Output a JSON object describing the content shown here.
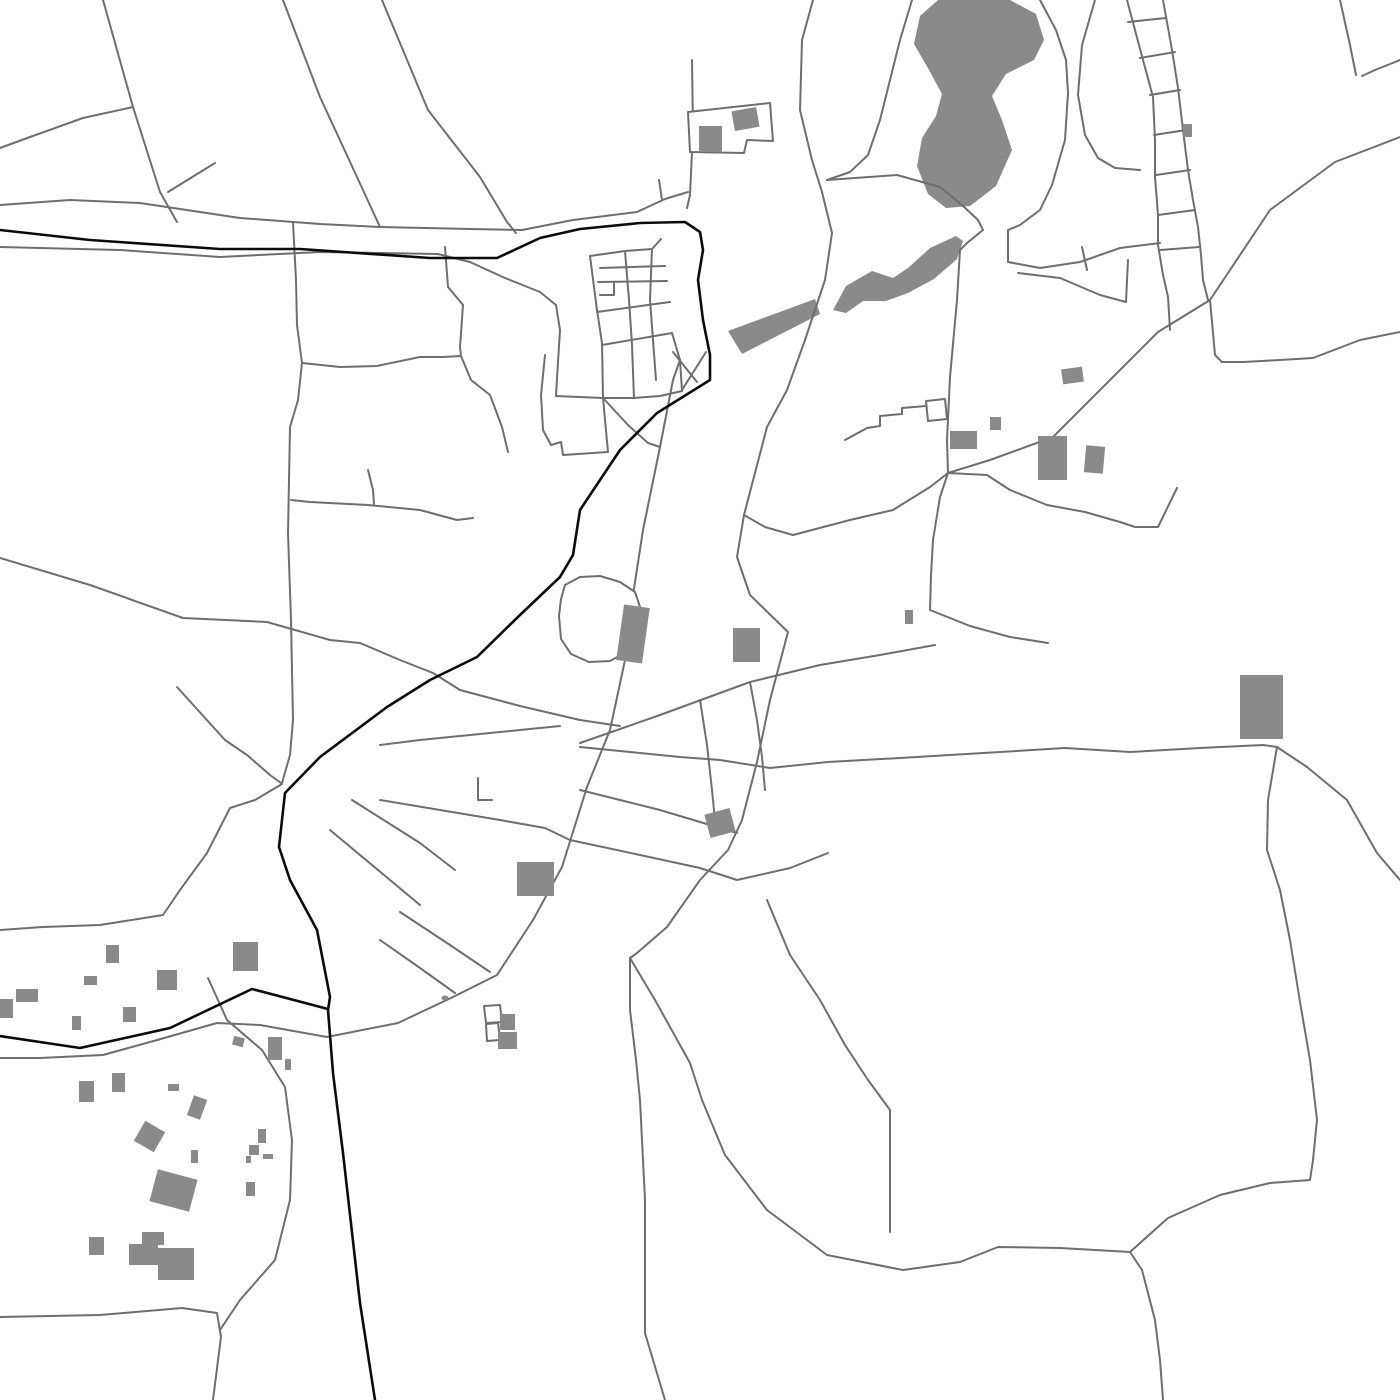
{
  "map": {
    "canvas": {
      "width": 1400,
      "height": 1400
    },
    "palette": {
      "background": "#ffffff",
      "road_gray": "#6e6e6e",
      "major_route_black": "#0b0b0b",
      "feature_fill_gray": "#8a8a8a",
      "outline_fill": "#ffffff"
    },
    "stroke": {
      "road_width": 2,
      "major_width": 2.6,
      "outline_width": 2
    },
    "major_routes": [
      {
        "points": "0,230 90,240 220,249 300,249 430,258 497,258 540,238 580,229 640,223 685,222 700,232 703,250 698,280 703,320 710,355 710,380 657,413 620,450 580,510 573,555 560,577 520,615 477,657 430,680 387,707 320,757 285,793 279,847 290,880 317,930 330,997 328,1010 333,1073 343,1153 360,1303 375,1400"
      },
      {
        "points": "0,1036 80,1048 170,1028 252,989 328,1009"
      }
    ],
    "roads": [
      {
        "points": "103,0 133,107 160,192 177,222"
      },
      {
        "points": "133,107 83,118 30,137 0,148"
      },
      {
        "points": "168,192 215,163"
      },
      {
        "points": "283,0 320,97 357,177 380,227"
      },
      {
        "points": "382,0 428,110 480,177 507,222 516,233"
      },
      {
        "points": "0,205 70,200 140,203 240,218 320,224 380,227 470,229 522,230 573,220 637,212 665,199 688,192"
      },
      {
        "points": "662,200 659,180"
      },
      {
        "points": "0,247 120,250 220,257 320,252 438,254"
      },
      {
        "points": "438,254 470,262 505,278 540,292 556,305 560,330 558,362 556,395"
      },
      {
        "points": "692,60 693,130 690,195 687,208"
      },
      {
        "points": "813,0 802,40 800,110 812,160 822,192 832,233"
      },
      {
        "points": "590,256 625,251 652,249 661,239"
      },
      {
        "points": "590,256 597,310 602,343 603,398"
      },
      {
        "points": "625,251 629,300 632,345 634,398"
      },
      {
        "points": "652,249 650,300 653,340 656,380"
      },
      {
        "points": "600,268 665,266"
      },
      {
        "points": "598,282 667,281"
      },
      {
        "points": "597,312 670,302"
      },
      {
        "points": "602,345 672,333"
      },
      {
        "points": "600,295 614,295 614,283"
      },
      {
        "points": "556,396 603,398 634,398 660,396 682,391"
      },
      {
        "points": "682,391 680,360 672,333"
      },
      {
        "points": "603,398 628,425 648,443 660,447"
      },
      {
        "points": "673,352 697,382"
      },
      {
        "points": "706,352 682,390"
      },
      {
        "points": "545,355 541,395 543,430 551,445 561,442 563,455 608,452 603,398"
      },
      {
        "points": "832,233 825,280 805,340 787,390 767,427 744,515 737,557 750,595 788,632 770,700 757,762 742,820 728,850 700,880 667,927 637,953 630,958"
      },
      {
        "points": "680,360 673,380 660,447 643,530 633,595 633,623 610,730 587,787 562,867 533,920 497,975 453,997 398,1023 327,1037 260,1025 217,1023 150,1042 103,1055 40,1058 0,1058"
      },
      {
        "points": "293,222 296,280 297,325 302,363 298,400 290,427 288,533 291,620 293,720 290,755 282,783"
      },
      {
        "points": "445,247 448,287 463,305 460,347 461,356"
      },
      {
        "points": "302,363 340,367 377,366 420,357 443,357 461,356 471,380 490,395 502,427 508,452"
      },
      {
        "points": "291,500 310,502 368,505 420,510 457,520 473,518"
      },
      {
        "points": "368,470 373,490 374,504"
      },
      {
        "points": "0,558 90,585 183,618 267,622 330,640 360,643 400,660 433,673 460,690 520,706 580,720 620,726"
      },
      {
        "points": "177,687 225,740 247,755 270,775 281,783"
      },
      {
        "points": "282,784 255,800 230,808 207,853 180,890 163,915 100,925 43,927 0,930"
      },
      {
        "points": "208,978 218,1000 227,1020 262,1050 285,1087 292,1140 290,1200 275,1260 240,1300 220,1330"
      },
      {
        "points": "0,1317 100,1315 182,1308 217,1313 221,1337 213,1400"
      },
      {
        "points": "630,958 630,1010 636,1060 640,1100 645,1200 645,1333 665,1400"
      },
      {
        "points": "630,958 655,1000 690,1063 702,1100 725,1155 767,1210 827,1255 903,1270 960,1262 998,1247 1060,1248 1130,1252"
      },
      {
        "points": "1130,1252 1168,1218 1220,1195 1270,1183 1310,1180"
      },
      {
        "points": "1130,1252 1142,1270 1155,1320 1160,1360 1163,1400"
      },
      {
        "points": "767,900 790,955 820,1000 845,1045 868,1080 890,1110 890,1232"
      },
      {
        "points": "1400,137 1335,162 1270,210 1210,300 1158,332 1110,380 1053,437 990,460 948,473"
      },
      {
        "points": "948,473 947,440 950,377 957,300 960,250 967,243 983,230"
      },
      {
        "points": "827,180 897,175 940,187 962,205 978,220 983,230"
      },
      {
        "points": "948,473 940,497 933,540 931,575 930,610 970,626 1010,637 1048,643"
      },
      {
        "points": "948,473 930,487 893,510 850,520 793,535 765,527 744,515"
      },
      {
        "points": "948,473 987,475 1010,490 1047,505 1085,512 1120,522 1135,527 1158,527 1177,488"
      },
      {
        "points": "770,768 828,762 900,758 1000,752 1065,748 1130,752 1200,748 1263,745 1277,747"
      },
      {
        "points": "1277,747 1268,800 1267,850 1280,890 1290,940 1300,1002 1310,1060 1317,1120 1313,1160 1310,1180"
      },
      {
        "points": "1277,747 1307,767 1347,800 1377,853 1400,880"
      },
      {
        "points": "1210,300 1215,355 1222,362 1243,362 1280,360 1313,358 1360,340 1400,332"
      },
      {
        "points": "1127,0 1143,60 1153,97 1155,140 1155,177 1158,215 1158,245 1163,275 1168,297 1170,330"
      },
      {
        "points": "1163,0 1172,50 1178,88 1183,130 1188,170 1193,200 1198,227 1201,255 1203,280 1208,300"
      },
      {
        "points": "1128,22 1166,18"
      },
      {
        "points": "1140,58 1175,52"
      },
      {
        "points": "1150,95 1180,90"
      },
      {
        "points": "1154,135 1186,130"
      },
      {
        "points": "1156,175 1190,170"
      },
      {
        "points": "1158,215 1195,210"
      },
      {
        "points": "1160,250 1199,247"
      },
      {
        "points": "1095,0 1082,45 1078,95 1085,135 1098,158 1115,168 1140,170"
      },
      {
        "points": "1340,0 1350,45 1356,75"
      },
      {
        "points": "1400,60 1375,70 1362,76"
      },
      {
        "points": "1008,230 1008,262 1040,268 1080,262 1120,248 1160,243"
      },
      {
        "points": "1082,247 1087,270"
      },
      {
        "points": "1018,273 1060,278 1100,295 1126,302"
      },
      {
        "points": "1126,302 1128,260"
      },
      {
        "points": "912,0 900,40 890,80 880,120 868,155 850,172 827,180"
      },
      {
        "points": "1040,0 1056,30 1066,60 1068,93 1065,140 1052,185 1040,210 1020,225 1008,230"
      },
      {
        "points": "580,743 660,715 750,682 820,665 880,655 935,645"
      },
      {
        "points": "580,747 630,752 680,757 720,760 770,768"
      },
      {
        "points": "580,790 620,800 660,810 700,822 737,833"
      },
      {
        "points": "570,840 640,855 700,868 737,880 790,868 828,853"
      },
      {
        "points": "700,700 707,745 712,790 716,830"
      },
      {
        "points": "750,682 757,720 762,757 765,790"
      },
      {
        "points": "380,745 420,740 470,735 520,730 560,726"
      },
      {
        "points": "478,778 478,800 492,800"
      },
      {
        "points": "380,800 440,810 500,820 545,828 570,840"
      },
      {
        "points": "400,912 450,945 490,972"
      },
      {
        "points": "380,940 420,968 455,993"
      },
      {
        "points": "352,800 420,843 455,870"
      },
      {
        "points": "330,830 390,880 420,905"
      },
      {
        "points": "845,440 867,428 880,426 880,416 902,414 902,408 926,406"
      }
    ],
    "water_bodies": [
      {
        "points": "938,0 1010,0 1036,14 1044,40 1034,60 1006,74 992,96 1002,120 1012,150 996,186 970,206 946,208 928,194 917,166 922,138 936,116 942,94 929,70 914,44 920,16"
      },
      {
        "points": "833,310 846,286 872,271 893,278 908,268 930,248 956,236 963,241 957,259 934,279 908,293 886,301 863,301 846,313"
      },
      {
        "points": "728,331 815,299 820,314 742,354"
      }
    ],
    "outlined_features": [
      {
        "points": "688,112 770,103 773,141 747,140 744,153 690,152"
      },
      {
        "points": "926,401 945,399 947,419 928,421"
      },
      {
        "points": "565,585 580,577 600,576 620,582 635,592 641,610 639,633 628,651 610,661 589,662 571,654 561,639 559,616 561,599"
      },
      {
        "points": "484,1006 500,1005 502,1022 486,1023"
      },
      {
        "points": "486,1024 498,1023 500,1040 487,1041"
      }
    ],
    "buildings": [
      {
        "x": 699,
        "y": 126,
        "w": 23,
        "h": 26,
        "r": 0
      },
      {
        "x": 733,
        "y": 109,
        "w": 25,
        "h": 20,
        "r": -10
      },
      {
        "x": 1183,
        "y": 124,
        "w": 9,
        "h": 13,
        "r": 0
      },
      {
        "x": 1062,
        "y": 368,
        "w": 21,
        "h": 15,
        "r": -8
      },
      {
        "x": 990,
        "y": 417,
        "w": 11,
        "h": 13,
        "r": 0
      },
      {
        "x": 950,
        "y": 431,
        "w": 27,
        "h": 18,
        "r": 0
      },
      {
        "x": 1038,
        "y": 436,
        "w": 29,
        "h": 44,
        "r": 0
      },
      {
        "x": 1085,
        "y": 446,
        "w": 19,
        "h": 27,
        "r": 5
      },
      {
        "x": 1240,
        "y": 675,
        "w": 43,
        "h": 64,
        "r": 0
      },
      {
        "x": 905,
        "y": 610,
        "w": 8,
        "h": 14,
        "r": 0
      },
      {
        "x": 620,
        "y": 606,
        "w": 26,
        "h": 56,
        "r": 8
      },
      {
        "x": 733,
        "y": 628,
        "w": 27,
        "h": 34,
        "r": 0
      },
      {
        "x": 707,
        "y": 811,
        "w": 26,
        "h": 24,
        "r": -15
      },
      {
        "x": 517,
        "y": 862,
        "w": 37,
        "h": 34,
        "r": 0
      },
      {
        "x": 500,
        "y": 1014,
        "w": 15,
        "h": 16,
        "r": 0
      },
      {
        "x": 498,
        "y": 1032,
        "w": 19,
        "h": 17,
        "r": 0
      },
      {
        "x": 106,
        "y": 945,
        "w": 13,
        "h": 18,
        "r": 0
      },
      {
        "x": 84,
        "y": 976,
        "w": 13,
        "h": 9,
        "r": 0
      },
      {
        "x": 157,
        "y": 970,
        "w": 20,
        "h": 20,
        "r": 0
      },
      {
        "x": 233,
        "y": 942,
        "w": 25,
        "h": 29,
        "r": 0
      },
      {
        "x": 16,
        "y": 989,
        "w": 22,
        "h": 13,
        "r": 0
      },
      {
        "x": 0,
        "y": 999,
        "w": 13,
        "h": 19,
        "r": 0
      },
      {
        "x": 72,
        "y": 1016,
        "w": 9,
        "h": 14,
        "r": 0
      },
      {
        "x": 123,
        "y": 1007,
        "w": 13,
        "h": 15,
        "r": 0
      },
      {
        "x": 233,
        "y": 1037,
        "w": 11,
        "h": 9,
        "r": 15
      },
      {
        "x": 268,
        "y": 1037,
        "w": 14,
        "h": 23,
        "r": 0
      },
      {
        "x": 285,
        "y": 1059,
        "w": 6,
        "h": 11,
        "r": 0
      },
      {
        "x": 79,
        "y": 1081,
        "w": 15,
        "h": 21,
        "r": 0
      },
      {
        "x": 112,
        "y": 1073,
        "w": 13,
        "h": 19,
        "r": 0
      },
      {
        "x": 168,
        "y": 1084,
        "w": 11,
        "h": 7,
        "r": 0
      },
      {
        "x": 190,
        "y": 1097,
        "w": 14,
        "h": 21,
        "r": 20
      },
      {
        "x": 138,
        "y": 1125,
        "w": 23,
        "h": 23,
        "r": 30
      },
      {
        "x": 191,
        "y": 1150,
        "w": 7,
        "h": 13,
        "r": 0
      },
      {
        "x": 153,
        "y": 1174,
        "w": 41,
        "h": 33,
        "r": 15
      },
      {
        "x": 89,
        "y": 1237,
        "w": 15,
        "h": 18,
        "r": 0
      },
      {
        "x": 142,
        "y": 1232,
        "w": 22,
        "h": 13,
        "r": 0
      },
      {
        "x": 129,
        "y": 1244,
        "w": 29,
        "h": 21,
        "r": 0
      },
      {
        "x": 158,
        "y": 1248,
        "w": 36,
        "h": 32,
        "r": 0
      },
      {
        "x": 258,
        "y": 1129,
        "w": 8,
        "h": 14,
        "r": 0
      },
      {
        "x": 249,
        "y": 1145,
        "w": 10,
        "h": 10,
        "r": 0
      },
      {
        "x": 246,
        "y": 1156,
        "w": 5,
        "h": 7,
        "r": 0
      },
      {
        "x": 263,
        "y": 1154,
        "w": 10,
        "h": 5,
        "r": 0
      },
      {
        "x": 246,
        "y": 1182,
        "w": 9,
        "h": 14,
        "r": 0
      }
    ],
    "dots": [
      {
        "cx": 445,
        "cy": 998,
        "r": 3.5
      }
    ]
  }
}
